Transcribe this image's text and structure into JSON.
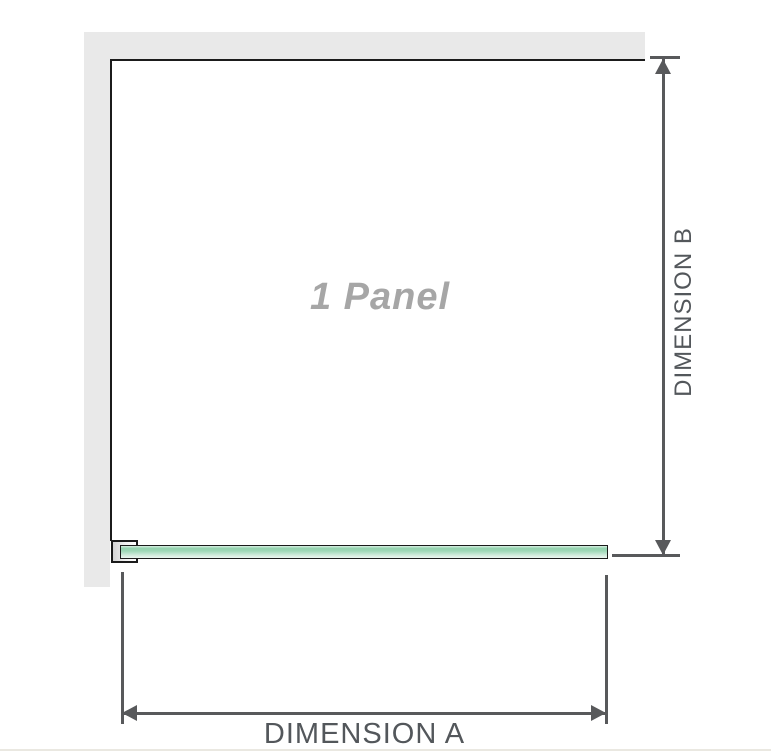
{
  "diagram": {
    "panel_label": "1 Panel",
    "dimension_a": {
      "label": "DIMENSION A"
    },
    "dimension_b": {
      "label": "DIMENSION B"
    }
  },
  "icons": {
    "dimension_b_arrows": [
      "arrow-up",
      "arrow-down"
    ],
    "dimension_a_arrows": [
      "arrow-left",
      "arrow-right"
    ]
  },
  "colors": {
    "wall": "#e9e9e9",
    "outline": "#1b1b1b",
    "dimension": "#58595b",
    "label_text": "#53575b",
    "panel_label_text": "#a6a6a6",
    "glass_top": "#93d2ae",
    "glass_bottom": "#ecf7f1",
    "baseline": "#eae8e1"
  }
}
